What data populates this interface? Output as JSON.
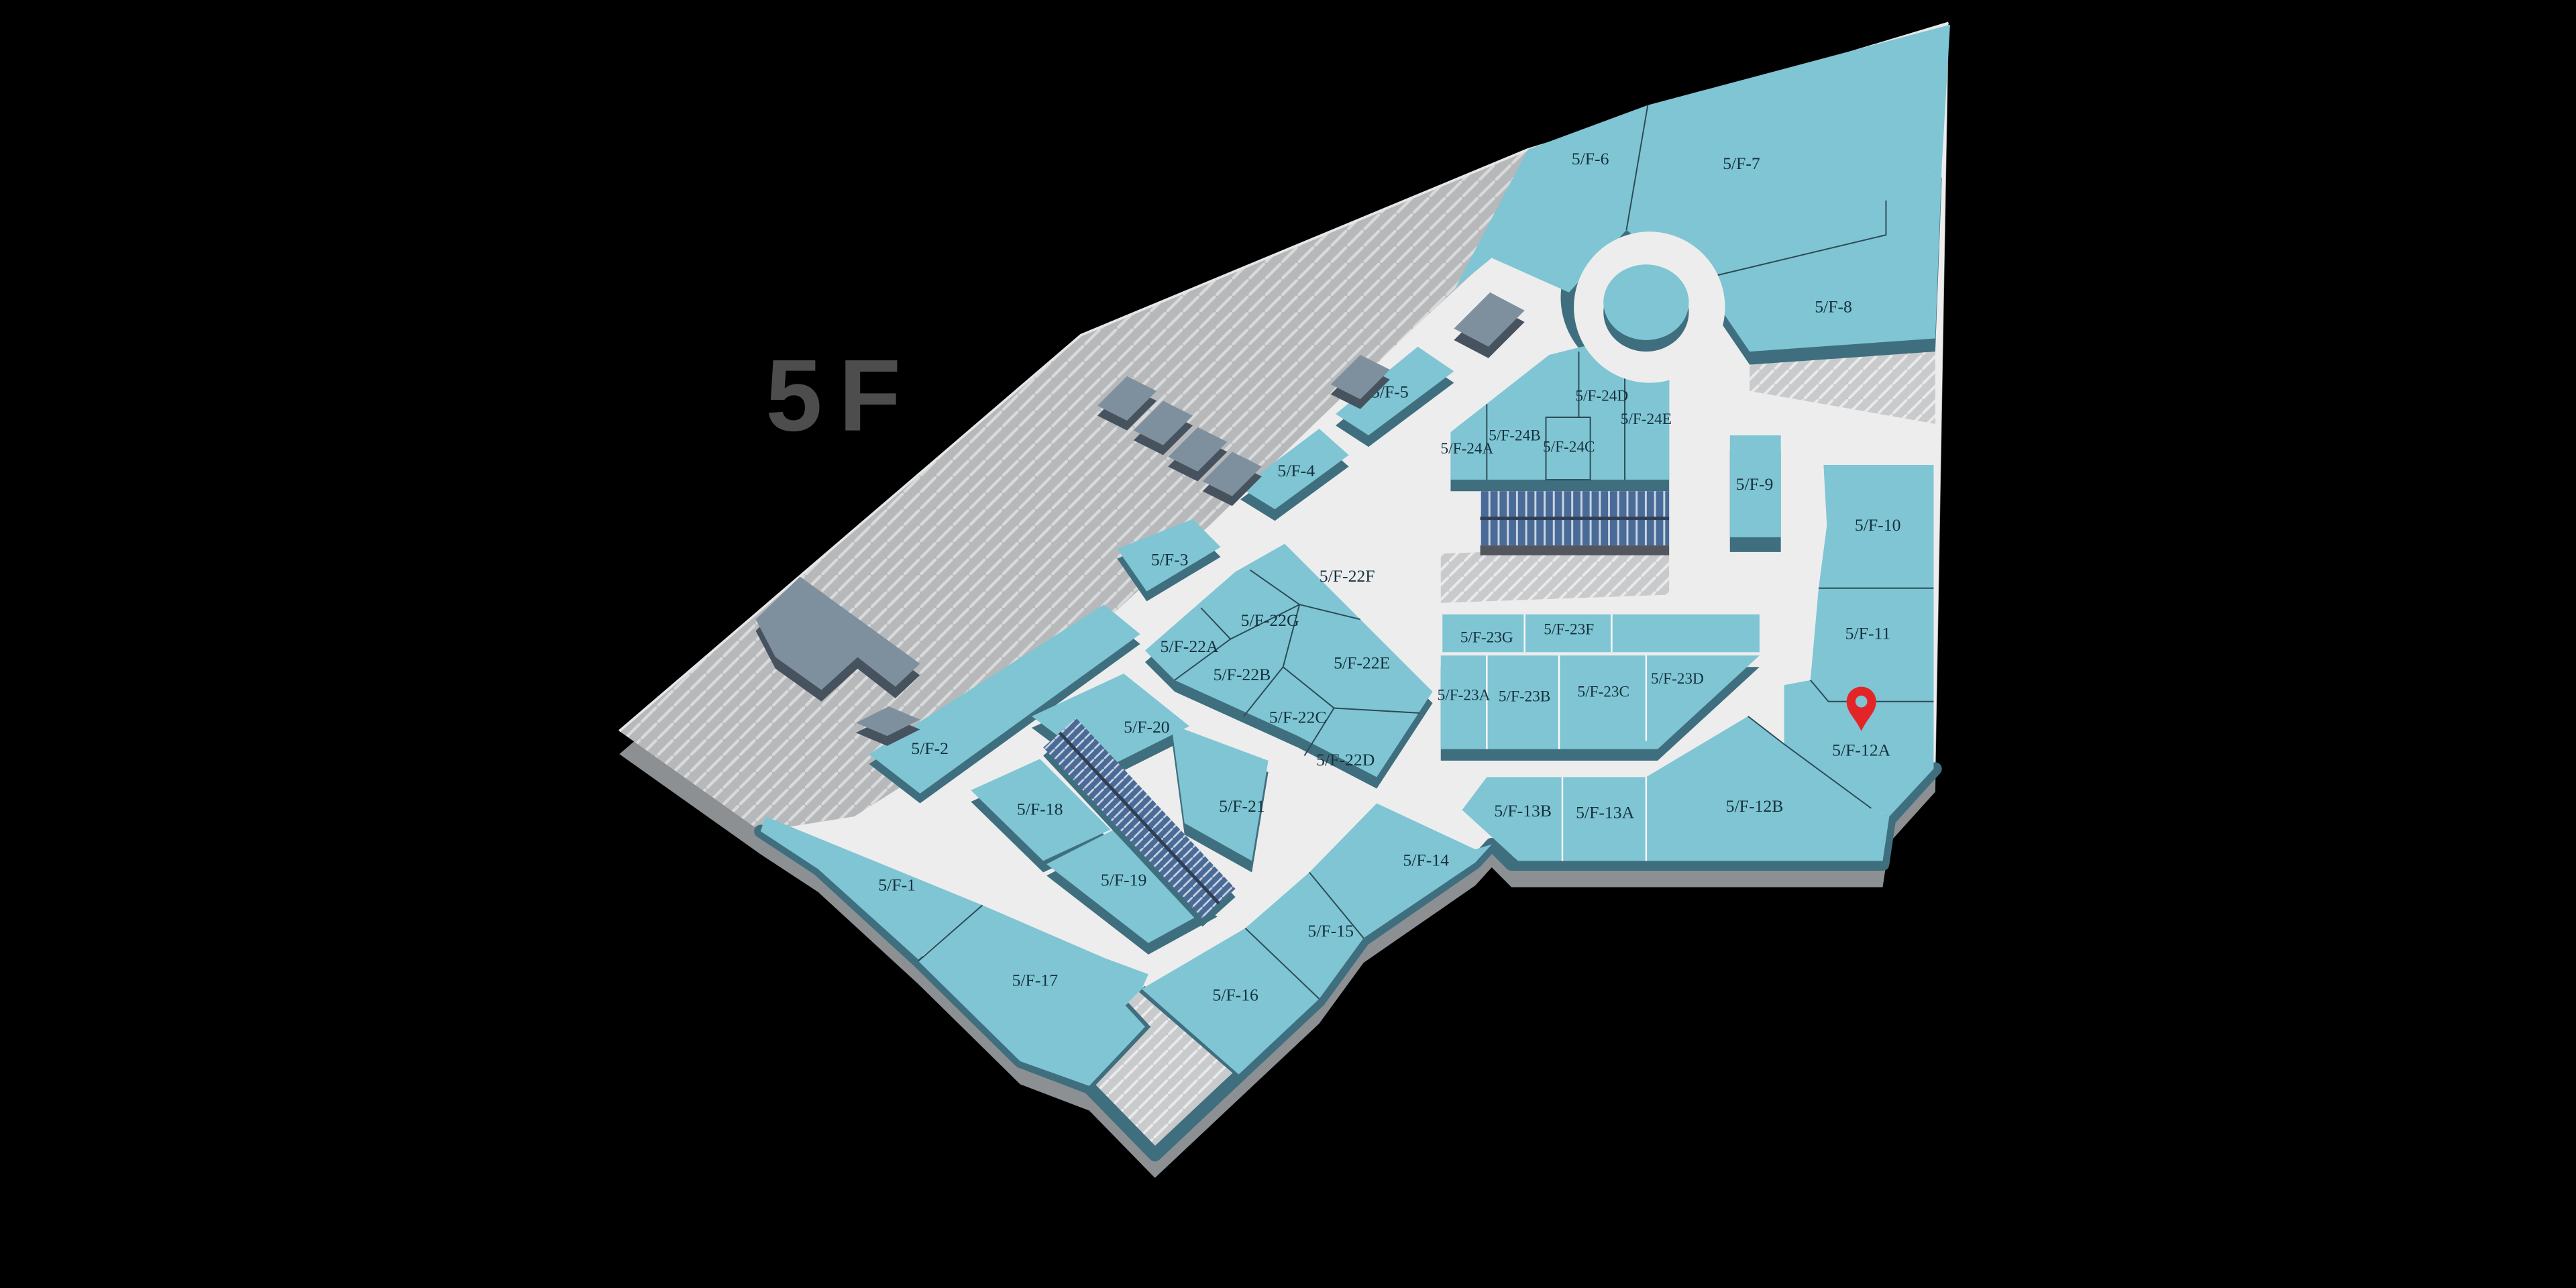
{
  "scene": {
    "type": "mall-floor-map",
    "floor_label": "5F"
  },
  "pin": {
    "located_unit": "5/F-12A",
    "color": "#e42528"
  },
  "colors": {
    "background": "#000000",
    "walkway": "#ededee",
    "unit_top": "#7fc5d4",
    "unit_side": "#3f6f7e",
    "hatch_area": "#b7b8ba",
    "hatch_area_light": "#c9cacc",
    "slate_structure_top": "#7e909d",
    "slate_structure_side": "#46525e",
    "escalator_blue": "#4a6b97",
    "outer_base": "#8d9093",
    "label_text": "#14313c",
    "floor_label_text": "#4d4d4d"
  },
  "units": [
    {
      "id": "5F-1",
      "label": "5/F-1"
    },
    {
      "id": "5F-2",
      "label": "5/F-2"
    },
    {
      "id": "5F-3",
      "label": "5/F-3"
    },
    {
      "id": "5F-4",
      "label": "5/F-4"
    },
    {
      "id": "5F-5",
      "label": "5/F-5"
    },
    {
      "id": "5F-6",
      "label": "5/F-6"
    },
    {
      "id": "5F-7",
      "label": "5/F-7"
    },
    {
      "id": "5F-8",
      "label": "5/F-8"
    },
    {
      "id": "5F-9",
      "label": "5/F-9"
    },
    {
      "id": "5F-10",
      "label": "5/F-10"
    },
    {
      "id": "5F-11",
      "label": "5/F-11"
    },
    {
      "id": "5F-12A",
      "label": "5/F-12A"
    },
    {
      "id": "5F-12B",
      "label": "5/F-12B"
    },
    {
      "id": "5F-13A",
      "label": "5/F-13A"
    },
    {
      "id": "5F-13B",
      "label": "5/F-13B"
    },
    {
      "id": "5F-14",
      "label": "5/F-14"
    },
    {
      "id": "5F-15",
      "label": "5/F-15"
    },
    {
      "id": "5F-16",
      "label": "5/F-16"
    },
    {
      "id": "5F-17",
      "label": "5/F-17"
    },
    {
      "id": "5F-18",
      "label": "5/F-18"
    },
    {
      "id": "5F-19",
      "label": "5/F-19"
    },
    {
      "id": "5F-20",
      "label": "5/F-20"
    },
    {
      "id": "5F-21",
      "label": "5/F-21"
    },
    {
      "id": "5F-22A",
      "label": "5/F-22A"
    },
    {
      "id": "5F-22B",
      "label": "5/F-22B"
    },
    {
      "id": "5F-22C",
      "label": "5/F-22C"
    },
    {
      "id": "5F-22D",
      "label": "5/F-22D"
    },
    {
      "id": "5F-22E",
      "label": "5/F-22E"
    },
    {
      "id": "5F-22F",
      "label": "5/F-22F"
    },
    {
      "id": "5F-22G",
      "label": "5/F-22G"
    },
    {
      "id": "5F-23A",
      "label": "5/F-23A"
    },
    {
      "id": "5F-23B",
      "label": "5/F-23B"
    },
    {
      "id": "5F-23C",
      "label": "5/F-23C"
    },
    {
      "id": "5F-23D",
      "label": "5/F-23D"
    },
    {
      "id": "5F-23F",
      "label": "5/F-23F"
    },
    {
      "id": "5F-23G",
      "label": "5/F-23G"
    },
    {
      "id": "5F-24A",
      "label": "5/F-24A"
    },
    {
      "id": "5F-24B",
      "label": "5/F-24B"
    },
    {
      "id": "5F-24C",
      "label": "5/F-24C"
    },
    {
      "id": "5F-24D",
      "label": "5/F-24D"
    },
    {
      "id": "5F-24E",
      "label": "5/F-24E"
    }
  ]
}
